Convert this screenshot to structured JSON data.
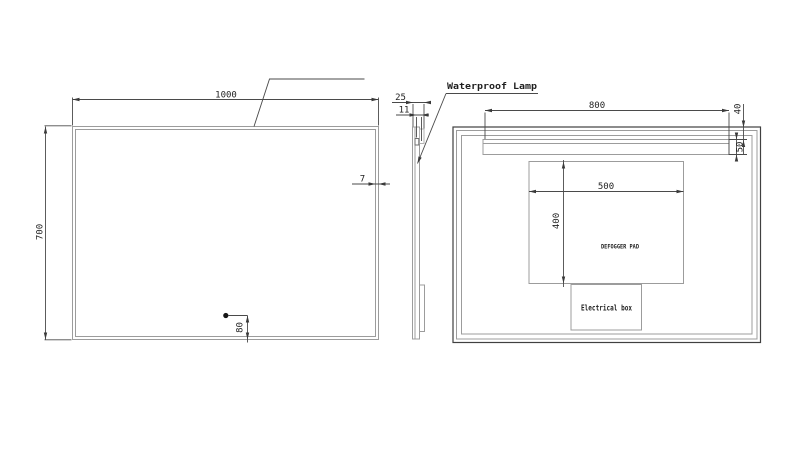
{
  "drawing": {
    "callout": {
      "waterproof_lamp": "Waterproof Lamp"
    },
    "front_view": {
      "dims": {
        "width": "1000",
        "height": "700",
        "frame_thickness": "7",
        "sensor_bottom_offset": "80"
      }
    },
    "side_view": {
      "dims": {
        "total_depth": "25",
        "lamp_depth": "11"
      }
    },
    "back_view": {
      "dims": {
        "lamp_strip_width": "800",
        "lamp_top_offset": "40",
        "lamp_strip_height": "50",
        "pad_width": "500",
        "pad_height": "400"
      },
      "labels": {
        "defogger_pad": "DEFOGGER PAD",
        "electrical_box": "Electrical box"
      }
    },
    "colors": {
      "outline_gray": "#9c9c9c",
      "outline_dark": "#404040",
      "dimension": "#4a4a4a",
      "text": "#1f1f1f",
      "background": "#ffffff"
    }
  }
}
